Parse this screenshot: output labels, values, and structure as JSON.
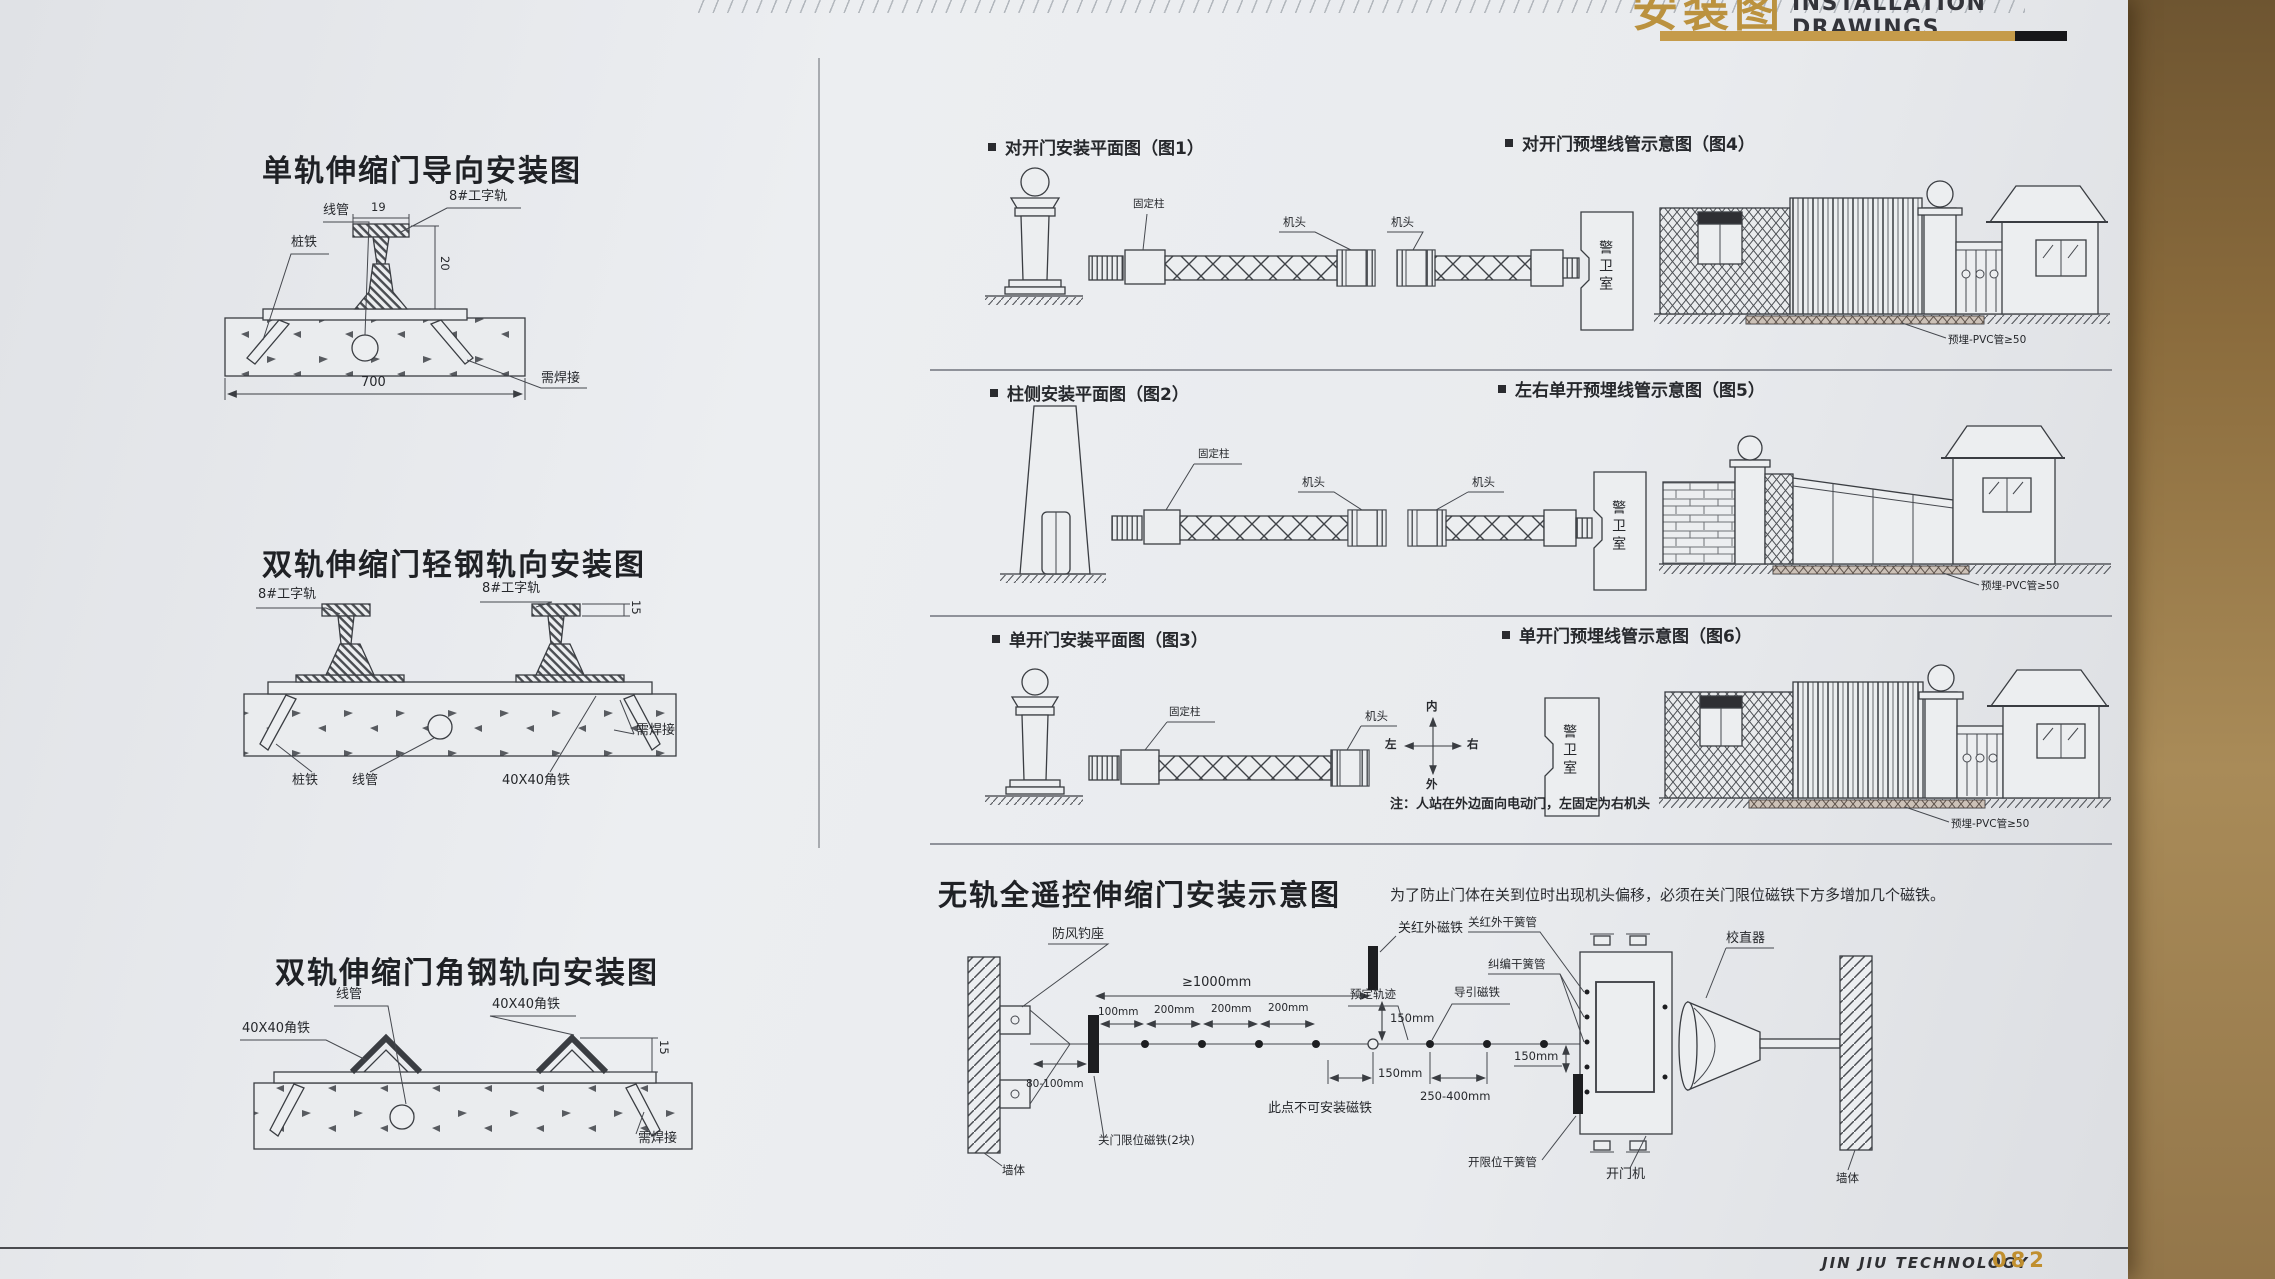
{
  "header": {
    "title_cn": "安装图",
    "title_en": "INSTALLATION DRAWINGS"
  },
  "left_sections": [
    {
      "title": "单轨伸缩门导向安装图",
      "labels": {
        "conduit": "线管",
        "stake": "桩铁",
        "rail": "8#工字轨",
        "dim_top": "19",
        "dim_height": "20",
        "dim_width": "700",
        "weld": "需焊接"
      }
    },
    {
      "title": "双轨伸缩门轻钢轨向安装图",
      "labels": {
        "rail_left": "8#工字轨",
        "rail_right": "8#工字轨",
        "dim_height": "15",
        "weld": "需焊接",
        "stake": "桩铁",
        "conduit": "线管",
        "angle": "40X40角铁"
      }
    },
    {
      "title": "双轨伸缩门角钢轨向安装图",
      "labels": {
        "conduit": "线管",
        "angle_left": "40X40角铁",
        "angle_right": "40X40角铁",
        "dim_height": "15",
        "weld": "需焊接"
      }
    }
  ],
  "right_rows": [
    {
      "caption_left": "对开门安装平面图（图1）",
      "caption_right": "对开门预埋线管示意图（图4）",
      "plan": {
        "fixed_post": "固定柱",
        "head_left": "机头",
        "head_right": "机头",
        "guard_room": "警卫室"
      },
      "elevation": {
        "pvc_note": "预埋-PVC管≥50"
      }
    },
    {
      "caption_left": "柱侧安装平面图（图2）",
      "caption_right": "左右单开预埋线管示意图（图5）",
      "plan": {
        "fixed_post": "固定柱",
        "head_left": "机头",
        "head_right": "机头",
        "guard_room": "警卫室"
      },
      "elevation": {
        "pvc_note": "预埋-PVC管≥50"
      }
    },
    {
      "caption_left": "单开门安装平面图（图3）",
      "caption_right": "单开门预埋线管示意图（图6）",
      "plan": {
        "fixed_post": "固定柱",
        "head": "机头",
        "guard_room": "警卫室"
      },
      "compass": {
        "top": "内",
        "bottom": "外",
        "left": "左",
        "right": "右"
      },
      "note": "注：人站在外边面向电动门，左固定为右机头",
      "elevation": {
        "pvc_note": "预埋-PVC管≥50"
      }
    }
  ],
  "bottom_section": {
    "title": "无轨全遥控伸缩门安装示意图",
    "note": "为了防止门体在关到位时出现机头偏移，必须在关门限位磁铁下方多增加几个磁铁。",
    "labels": {
      "wind_hook": "防风钓座",
      "close_ir_magnet": "关红外磁铁",
      "close_ir_reed": "关红外干簧管",
      "correction_reed": "纠编干簧管",
      "straightener": "校直器",
      "dim_min_gap": "≥1000mm",
      "dim_100": "100mm",
      "dim_200_a": "200mm",
      "dim_200_b": "200mm",
      "dim_200_c": "200mm",
      "dim_150_a": "150mm",
      "dim_150_b": "150mm",
      "dim_150_c": "150mm",
      "dim_250_400": "250-400mm",
      "dim_80_100": "80-100mm",
      "track": "预定轨迹",
      "guide_magnet": "导引磁铁",
      "no_magnet_point": "此点不可安装磁铁",
      "close_limit_magnet": "关门限位磁铁(2块)",
      "open_limit_reed": "开限位干簧管",
      "opener": "开门机",
      "wall_left": "墙体",
      "wall_right": "墙体"
    }
  },
  "footer": {
    "brand": "JIN JIU TECHNOLOGY",
    "page_number": "082"
  }
}
